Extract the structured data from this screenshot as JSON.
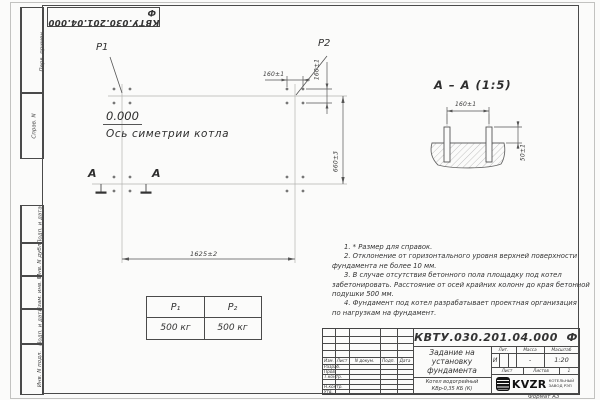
{
  "sheet": {
    "corner_designation": "КВТУ.030.201.04.000  Ф",
    "format_label": "Формат А3"
  },
  "frame_labels": {
    "perv_primen": "Перв. примен.",
    "sprav_n": "Справ. N",
    "podp_data_1": "Подп. и дата",
    "inv_dubl": "Инв. N дубл.",
    "vzam_inv": "Взам. инв. N",
    "podp_data_2": "Подп. и дата",
    "inv_podl": "Инв. N подл."
  },
  "plan": {
    "p1": "P1",
    "p2": "P2",
    "elevation": "0.000",
    "axis_label": "Ось симетрии котла",
    "section_letter_left": "А",
    "section_letter_right": "А",
    "dim_length": "1625±2",
    "dim_width": "660±3",
    "dim_bolt_x": "160±1",
    "dim_bolt_y": "160±1"
  },
  "section": {
    "title": "А – А (1:5)",
    "dim_bolts": "160±1",
    "dim_height": "50±1"
  },
  "notes_lines": [
    "1. * Размер для справок.",
    "2. Отклонение от горизонтального уровня верхней поверхности",
    "фундамента не более 10 мм.",
    "3. В случае отсутствия бетонного пола площадку под котел",
    "забетонировать. Расстояние от осей крайних колонн до края бетонной",
    "подушки 500 мм.",
    "4. Фундамент под котел разрабатывает проектная организация",
    "по нагрузкам на фундамент."
  ],
  "load_table": {
    "col1_header": "P₁",
    "col2_header": "P₂",
    "col1_value": "500 кг",
    "col2_value": "500 кг"
  },
  "title_block": {
    "designation": "КВТУ.030.201.04.000  Ф",
    "doc_title": "Задание на установку фундамента",
    "product": "Котел водогрейный КВр-0,35 КБ (К)",
    "col_izm": "Изм.",
    "col_list": "Лист",
    "col_dokum": "N докум.",
    "col_podp": "Подп.",
    "col_data": "Дата",
    "role_razrab": "Разраб.",
    "role_prov": "Пров.",
    "role_tkontr": "Т.контр.",
    "role_nkontr": "Н.контр.",
    "role_utv": "Утв.",
    "lit_label": "Лит.",
    "lit_value": "И",
    "mass_label": "Масса",
    "mass_value": "-",
    "scale_label": "Масштаб",
    "scale_value": "1:20",
    "sheet_label": "Лист",
    "sheets_label": "Листов",
    "sheets_value": "1",
    "brand": "KVZR",
    "brand_sub1": "КОТЕЛЬНЫЙ",
    "brand_sub2": "ЗАВОД РЭП"
  }
}
